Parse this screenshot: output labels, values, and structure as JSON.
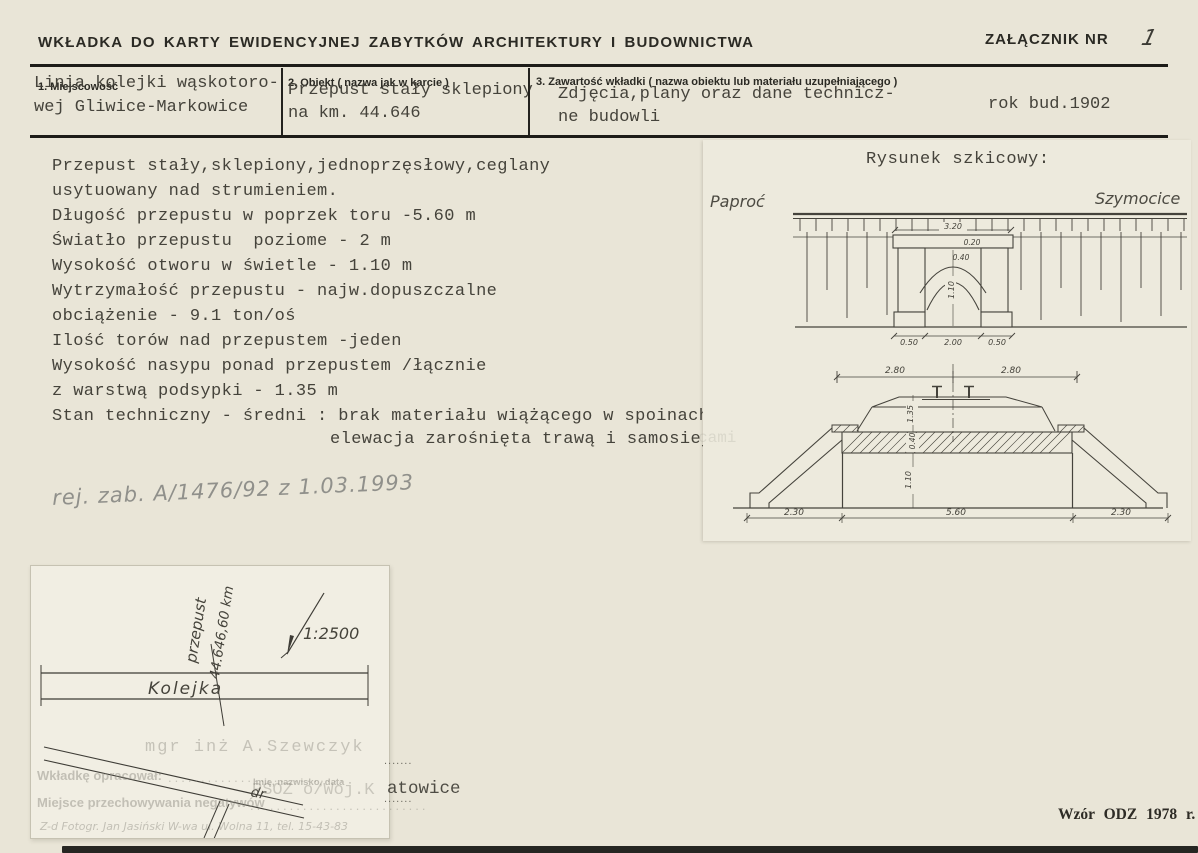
{
  "page": {
    "header_title": "WKŁADKA DO KARTY EWIDENCYJNEJ ZABYTKÓW ARCHITEKTURY I BUDOWNICTWA",
    "attachment_label": "ZAŁĄCZNIK NR",
    "attachment_number": "1"
  },
  "form": {
    "field1": {
      "label": "1. Miejscowość",
      "line1": "Linia kolejki wąskotoro-",
      "line2": "wej Gliwice-Markowice"
    },
    "field2": {
      "label": "2. Obiekt ( nazwa jak w karcie )",
      "line1": "Przepust stały sklepiony",
      "line2": "na km. 44.646"
    },
    "field3": {
      "label": "3. Zawartość wkładki ( nazwa obiektu lub materiału uzupełniającego )",
      "line1": "Zdjęcia,plany oraz dane technicz-",
      "line2": "ne budowli",
      "year": "rok bud.1902"
    }
  },
  "description": {
    "lines": [
      "Przepust stały,sklepiony,jednoprzęsłowy,ceglany",
      "usytuowany nad strumieniem.",
      "Długość przepustu w poprzek toru -5.60 m",
      "Światło przepustu  poziome - 2 m",
      "Wysokość otworu w świetle - 1.10 m",
      "Wytrzymałość przepustu - najw.dopuszczalne",
      "obciążenie - 9.1 ton/oś",
      "Ilość torów nad przepustem -jeden",
      "Wysokość nasypu ponad przepustem /łącznie",
      "z warstwą podsypki - 1.35 m",
      "Stan techniczny - średni : brak materiału wiążącego w spoinach",
      "elewacja zarośnięta trawą i samosiej"
    ]
  },
  "notes": {
    "register": "rej. zab. A/1476/92 z 1.03.1993"
  },
  "sketch": {
    "title": "Rysunek szkicowy:",
    "left_station": "Paproć",
    "right_station": "Szymocice",
    "elevation": {
      "top_width": "3.20",
      "cap_height": "0.20",
      "arch_ring": "0.40",
      "clear_height": "1.10",
      "pier_left": "0.50",
      "span": "2.00",
      "pier_right": "0.50"
    },
    "section": {
      "left_half": "2.80",
      "right_half": "2.80",
      "fill_height": "1.35",
      "ring": "0.40",
      "clear_height": "1.10",
      "wing_left": "2.30",
      "length": "5.60",
      "wing_right": "2.30"
    }
  },
  "site_plan": {
    "railway": "Kolejka",
    "culvert": "przepust",
    "km": "44.646,60 km",
    "scale": "1:2500",
    "road": "dr"
  },
  "bleedthrough": {
    "author": "mgr inż A.Szewczyk",
    "prepared_label": "Wkładkę opracował:",
    "name_date_label": "Imię, nazwisko, data",
    "office_faint": "PSOZ o/Woj.K",
    "office_visible": "atowice",
    "negatives_label": "Miejsce przechowywania negatywów",
    "photo_lab": "Z-d Fotogr. Jan Jasiński W-wa ul. Wolna 11, tel. 15-43-83",
    "dots_short": ".......",
    "leader_dots": "...........................",
    "ghost_fragment": "cami"
  },
  "footer": {
    "right": "Wzór ODZ 1978 r."
  }
}
